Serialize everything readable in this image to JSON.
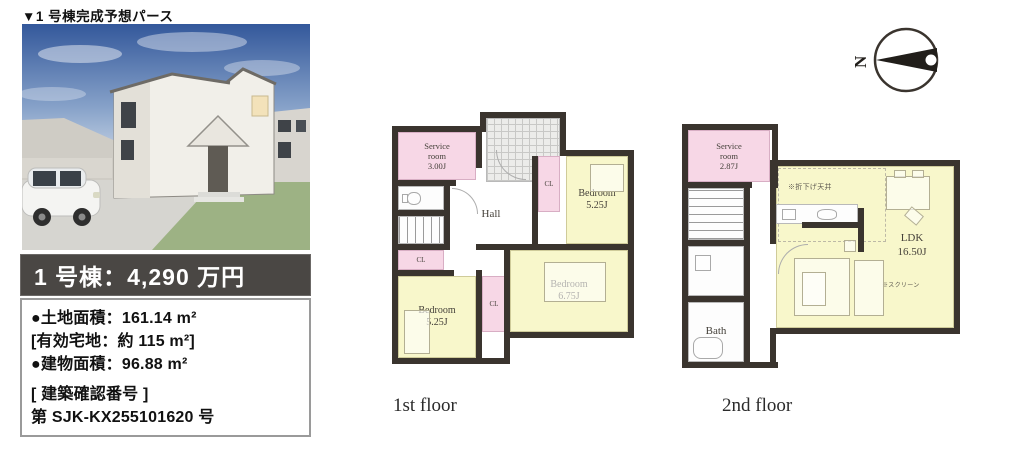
{
  "colors": {
    "wall": "#3a342e",
    "room_yellow": "#f8f7cb",
    "room_pink": "#f7d7e6",
    "price_banner_bg": "#4a4744",
    "sky_blue": "#33589b",
    "lawn_green": "#9db284"
  },
  "header": {
    "caption": "▼1 号棟完成予想パース"
  },
  "listing": {
    "price": "1 号棟：4,290 万円",
    "land_area": "●土地面積：161.14 m²",
    "effective_land": "[有効宅地：約 115 m²]",
    "building_area": "●建物面積：96.88 m²",
    "confirmation_label": "[ 建築確認番号 ]",
    "confirmation_number": "第 SJK-KX255101620 号"
  },
  "compass": {
    "north_label": "N"
  },
  "floor1": {
    "caption": "1st floor",
    "service_room": "Service\nroom\n3.00J",
    "hall": "Hall",
    "bedroom_top_right": "Bedroom\n5.25J",
    "bedroom_bottom_left": "Bedroom\n5.25J",
    "bedroom_bottom_right": "Bedroom\n6.75J",
    "closet_left": "CL",
    "closet_mid": "CL",
    "closet_center": "CL"
  },
  "floor2": {
    "caption": "2nd floor",
    "service_room": "Service\nroom\n2.87J",
    "bath": "Bath",
    "ldk": "LDK\n16.50J",
    "ceiling_note": "※折下げ天井",
    "screen_note": "※スクリーン"
  }
}
